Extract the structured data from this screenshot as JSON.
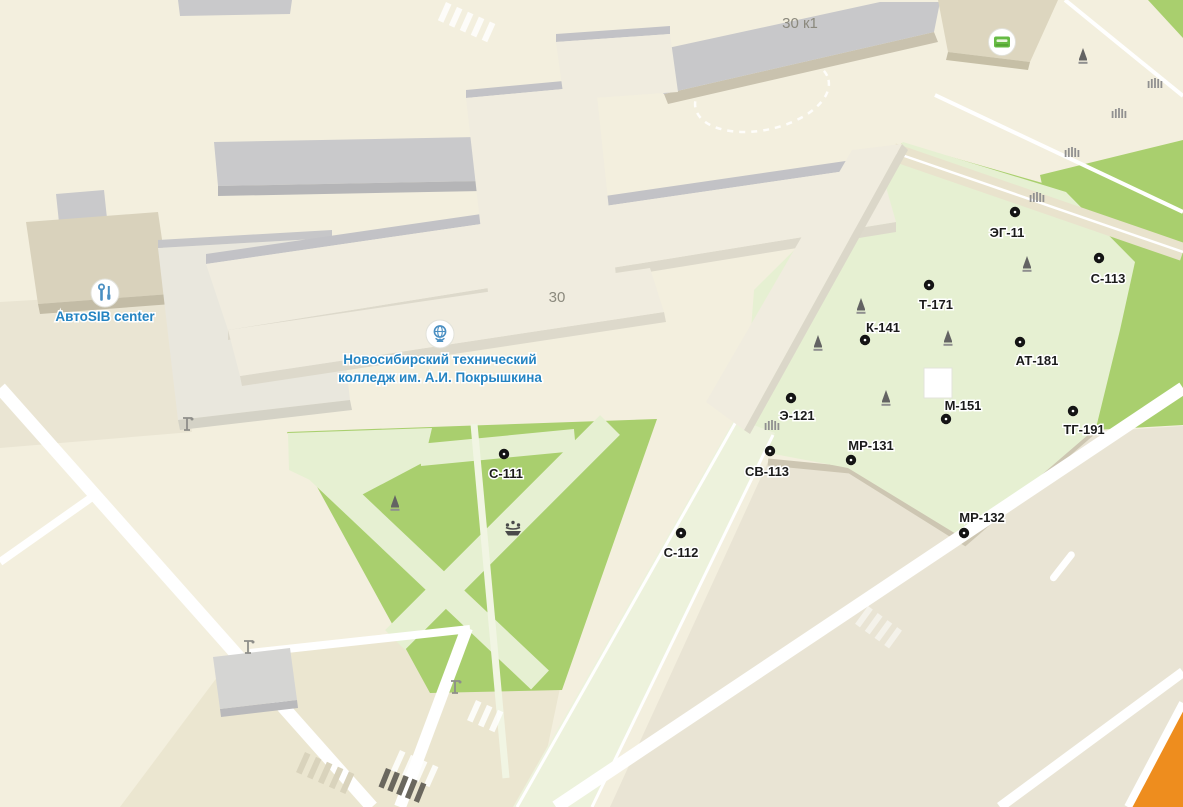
{
  "map": {
    "colors": {
      "background": "#f3efde",
      "lawn_green": "#a9cf6e",
      "lawn_pale": "#e6f0d2",
      "orange_road": "#ee8d1e",
      "road_white": "#ffffff",
      "marker_black": "#141414",
      "poi_label": "#1b1b1b",
      "label_blue": "#2484c2",
      "building_label_gray": "#8b897d",
      "atm_green": "#66bb44",
      "icon_blue": "#4a8fc2",
      "tree_gray": "#636363",
      "fence_gray": "#909090"
    },
    "building_labels": [
      {
        "text": "30 к1",
        "x": 800,
        "y": 28
      },
      {
        "text": "30",
        "x": 557,
        "y": 302
      }
    ],
    "places": {
      "avtosib": {
        "label": "АвтоSIB center",
        "icon": "wrench-tools",
        "icon_x": 105,
        "icon_y": 293,
        "label_x": 105,
        "label_y": 321
      },
      "college": {
        "line1": "Новосибирский технический",
        "line2": "колледж им. А.И. Покрышкина",
        "icon": "globe",
        "icon_x": 440,
        "icon_y": 334,
        "label_x": 440,
        "label_y": 364
      }
    },
    "pois": [
      {
        "label": "С-111",
        "dot_x": 504,
        "dot_y": 454,
        "label_x": 506,
        "label_y": 478
      },
      {
        "label": "С-112",
        "dot_x": 681,
        "dot_y": 533,
        "label_x": 681,
        "label_y": 557
      },
      {
        "label": "С-113",
        "dot_x": 1099,
        "dot_y": 258,
        "label_x": 1108,
        "label_y": 283
      },
      {
        "label": "СВ-113",
        "dot_x": 770,
        "dot_y": 451,
        "label_x": 767,
        "label_y": 476
      },
      {
        "label": "Э-121",
        "dot_x": 791,
        "dot_y": 398,
        "label_x": 797,
        "label_y": 420
      },
      {
        "label": "ЭГ-11",
        "dot_x": 1015,
        "dot_y": 212,
        "label_x": 1007,
        "label_y": 237
      },
      {
        "label": "К-141",
        "dot_x": 865,
        "dot_y": 340,
        "label_x": 883,
        "label_y": 332
      },
      {
        "label": "Т-171",
        "dot_x": 929,
        "dot_y": 285,
        "label_x": 936,
        "label_y": 309
      },
      {
        "label": "АТ-181",
        "dot_x": 1020,
        "dot_y": 342,
        "label_x": 1037,
        "label_y": 365
      },
      {
        "label": "М-151",
        "dot_x": 946,
        "dot_y": 419,
        "label_x": 963,
        "label_y": 410
      },
      {
        "label": "МР-131",
        "dot_x": 851,
        "dot_y": 460,
        "label_x": 871,
        "label_y": 450
      },
      {
        "label": "МР-132",
        "dot_x": 964,
        "dot_y": 533,
        "label_x": 982,
        "label_y": 522
      },
      {
        "label": "ТГ-191",
        "dot_x": 1073,
        "dot_y": 411,
        "label_x": 1084,
        "label_y": 434
      }
    ],
    "icons": {
      "atm": {
        "x": 1002,
        "y": 42
      },
      "fountain": {
        "x": 513,
        "y": 532
      },
      "trees": [
        [
          1083,
          63
        ],
        [
          1027,
          271
        ],
        [
          948,
          345
        ],
        [
          861,
          313
        ],
        [
          818,
          350
        ],
        [
          886,
          405
        ],
        [
          395,
          510
        ]
      ],
      "fences": [
        [
          1155,
          88
        ],
        [
          1119,
          118
        ],
        [
          1072,
          157
        ],
        [
          1037,
          202
        ],
        [
          772,
          430
        ]
      ],
      "streetlights": [
        [
          187,
          427
        ],
        [
          248,
          650
        ],
        [
          455,
          690
        ]
      ]
    }
  }
}
